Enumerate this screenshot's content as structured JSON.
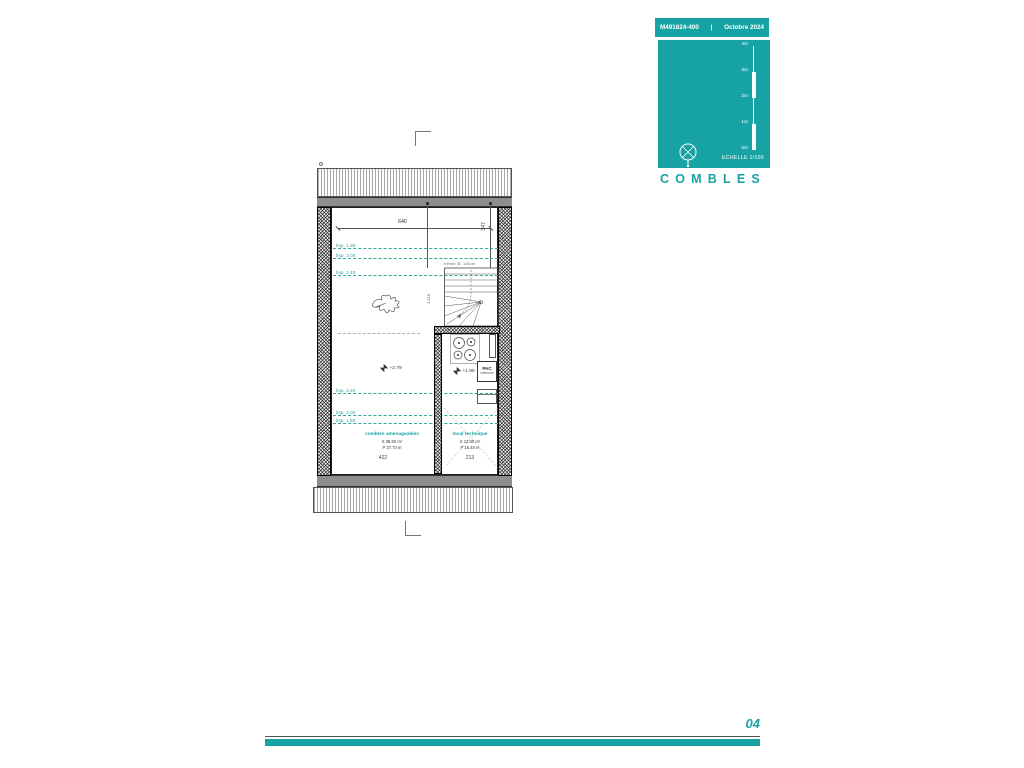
{
  "header": {
    "ref": "M491824-400",
    "sep": "|",
    "date": "Octobre 2024"
  },
  "legend": {
    "title": "COMBLES",
    "scale_label": "ECHELLE  1/100",
    "scale_ticks": [
      "4m",
      "3m",
      "2m",
      "1m",
      "0m"
    ]
  },
  "plan": {
    "dim_top": "640",
    "dim_right": "347",
    "dim_stair": "1.116",
    "dim_bottom_left": "422",
    "dim_bottom_right": "213",
    "stair_note": "trémie W. 116cm",
    "levels": {
      "main": "+2.79",
      "technique": "+1.95"
    },
    "hsp_lines": [
      {
        "label": "hsp. 1.80"
      },
      {
        "label": "hsp. 2.00"
      },
      {
        "label": "hsp. 2.40"
      },
      {
        "label": "hsp. 2.40"
      },
      {
        "label": "hsp. 2.00"
      },
      {
        "label": "hsp. 1.80"
      }
    ],
    "rooms": [
      {
        "name": "combles aménageables",
        "surface": "S  38.50 m²",
        "perimeter": "P  37.73 m"
      },
      {
        "name": "local technique",
        "surface": "S  13.80 m²",
        "perimeter": "P  16.48 m"
      }
    ],
    "equipment": {
      "pac_label": "PAC",
      "pac_sub": "intérieure"
    }
  },
  "footer": {
    "page": "04"
  }
}
